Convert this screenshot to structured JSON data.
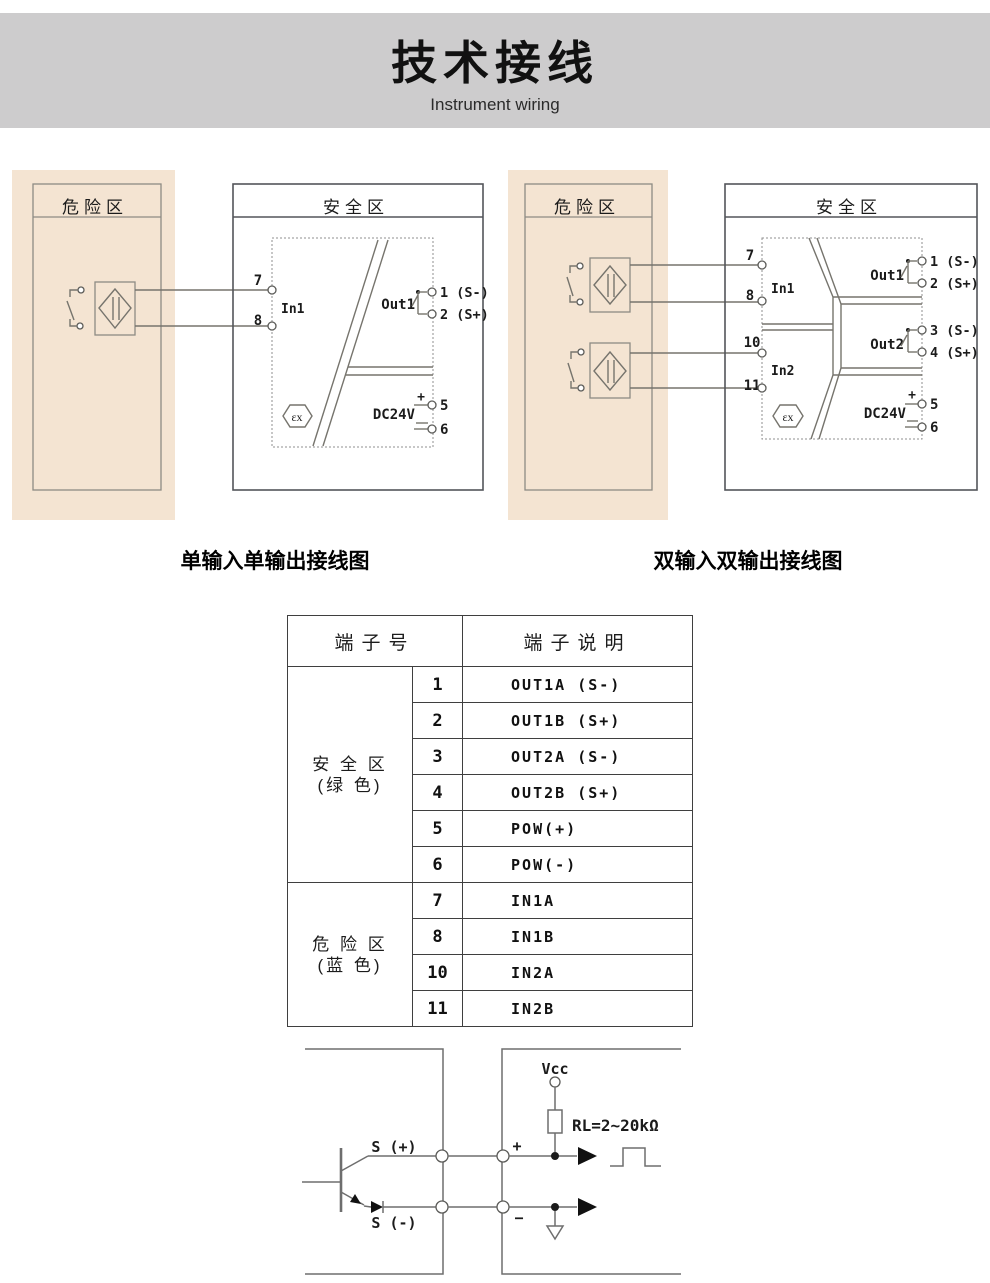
{
  "header": {
    "title": "技术接线",
    "subtitle": "Instrument wiring"
  },
  "colors": {
    "header_band": "#cdcccd",
    "hazard_zone_bg": "#f4e4d2"
  },
  "left_diagram": {
    "hazard_zone": "危险区",
    "safe_zone": "安全区",
    "caption": "单输入单输出接线图",
    "t7": "7",
    "t8": "8",
    "in1": "In1",
    "out1": "Out1",
    "t1": "1 (S-)",
    "t2": "2 (S+)",
    "power": "DC24V",
    "plus": "+",
    "minus": "−",
    "t5": "5",
    "t6": "6",
    "ex": "εx"
  },
  "right_diagram": {
    "hazard_zone": "危险区",
    "safe_zone": "安全区",
    "caption": "双输入双输出接线图",
    "t7": "7",
    "t8": "8",
    "t10": "10",
    "t11": "11",
    "in1": "In1",
    "in2": "In2",
    "out1": "Out1",
    "out2": "Out2",
    "t1": "1 (S-)",
    "t2": "2 (S+)",
    "t3": "3 (S-)",
    "t4": "4 (S+)",
    "power": "DC24V",
    "plus": "+",
    "minus": "−",
    "t5": "5",
    "t6": "6",
    "ex": "εx"
  },
  "table": {
    "header_terminal": "端子号",
    "header_desc": "端子说明",
    "group1_line1": "安 全 区",
    "group1_line2": "(绿 色)",
    "group2_line1": "危 险 区",
    "group2_line2": "(蓝 色)",
    "rows": [
      {
        "num": "1",
        "desc": "OUT1A (S-)"
      },
      {
        "num": "2",
        "desc": "OUT1B (S+)"
      },
      {
        "num": "3",
        "desc": "OUT2A (S-)"
      },
      {
        "num": "4",
        "desc": "OUT2B (S+)"
      },
      {
        "num": "5",
        "desc": "POW(+)"
      },
      {
        "num": "6",
        "desc": "POW(-)"
      },
      {
        "num": "7",
        "desc": "IN1A"
      },
      {
        "num": "8",
        "desc": "IN1B"
      },
      {
        "num": "10",
        "desc": "IN2A"
      },
      {
        "num": "11",
        "desc": "IN2B"
      }
    ]
  },
  "circuit": {
    "s_plus": "S (+)",
    "s_minus": "S (-)",
    "vcc": "Vcc",
    "rl": "RL=2~20kΩ",
    "plus": "+",
    "minus": "−"
  }
}
